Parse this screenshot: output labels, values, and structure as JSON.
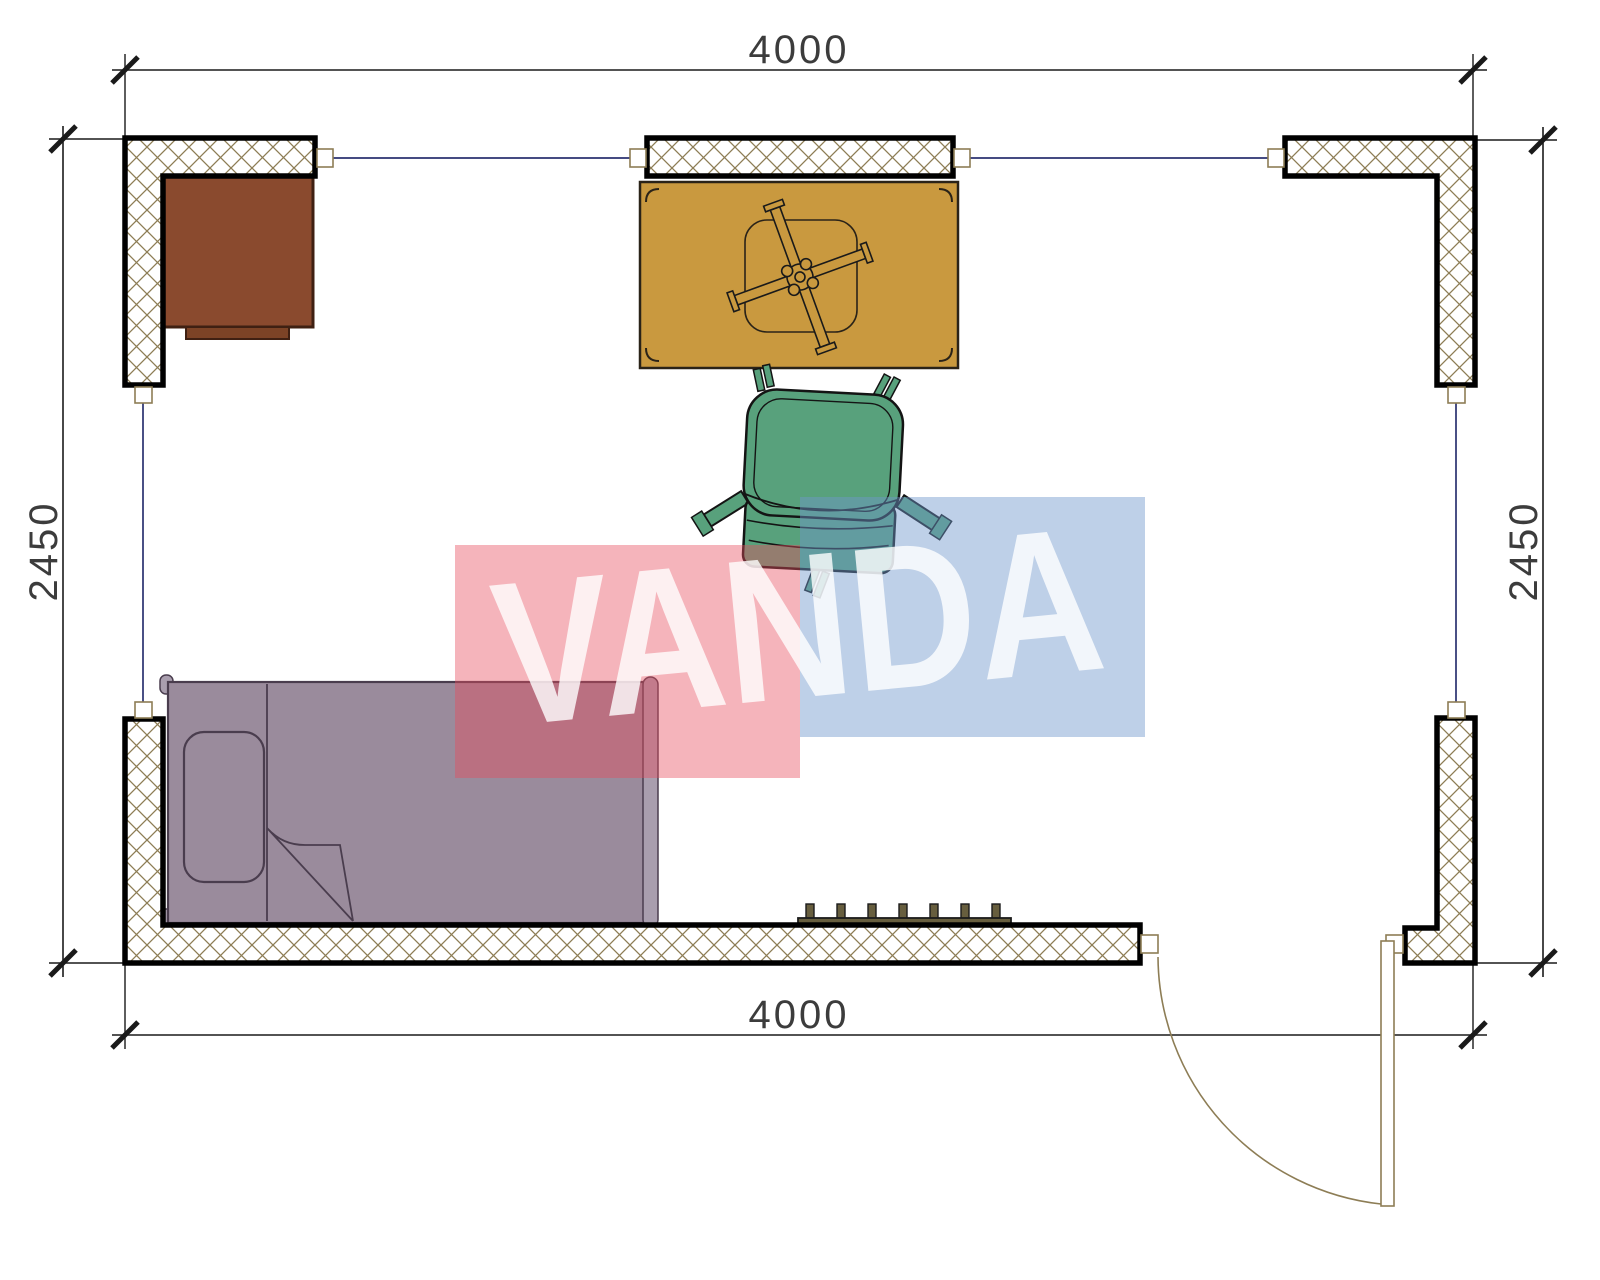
{
  "title": "Room floor plan 4000 x 2450",
  "dimensions": {
    "top": "4000",
    "bottom": "4000",
    "left": "2450",
    "right": "2450"
  },
  "watermark": {
    "text": "VANDA"
  },
  "furniture_icons": [
    "desk-cabinet-icon",
    "table-with-fan-base-icon",
    "office-chair-top-view-icon",
    "single-bed-icon",
    "radiator-icon",
    "door-swing-icon",
    "window-icon"
  ],
  "colors": {
    "wall_outline": "#000000",
    "wall_hatch": "#8d7d55",
    "window_frame": "#8d7d55",
    "window_line": "#2b3270",
    "dimension_line": "#1a1a1a",
    "dimension_text": "#3c3c3c",
    "desk": "#8a4a2e",
    "desk_drawer": "#7c4326",
    "desk_outline": "#3f2012",
    "table": "#c9993f",
    "table_outline": "#2a2318",
    "chair": "#58a17c",
    "chair_outline": "#141414",
    "bed": "#9a8b9c",
    "bed_post": "#a99eae",
    "bed_outline": "#4a3d4e",
    "radiator": "#675e3e",
    "door": "#8d7d55",
    "watermark_red": "#e84c5d",
    "watermark_blue": "#6f97cc",
    "watermark_text": "#ffffff"
  }
}
